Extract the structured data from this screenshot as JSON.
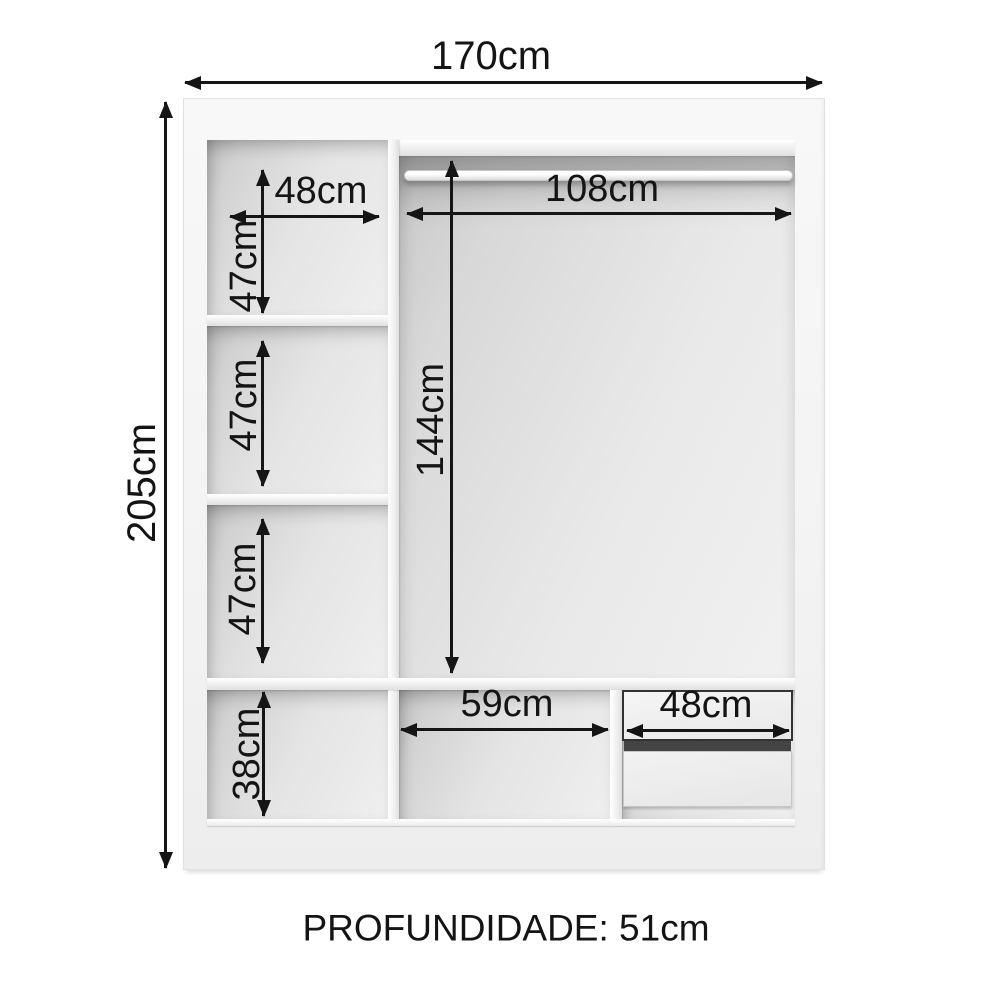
{
  "labels": {
    "width_total": "170cm",
    "height_total": "205cm",
    "top_left_width": "48cm",
    "shelf1_height": "47cm",
    "shelf2_height": "47cm",
    "shelf3_height": "47cm",
    "bottom_left_height": "38cm",
    "rod_width": "108cm",
    "hanging_height": "144cm",
    "bottom_middle_width": "59cm",
    "drawer_width": "48cm",
    "depth": "PROFUNDIDADE: 51cm"
  },
  "colors": {
    "background": "#ffffff",
    "cabinet_surface": "#f4f4f4",
    "interior_shadow": "#c9c9c9",
    "dimension_lines": "#151515",
    "drawer_gap": "#444444"
  }
}
